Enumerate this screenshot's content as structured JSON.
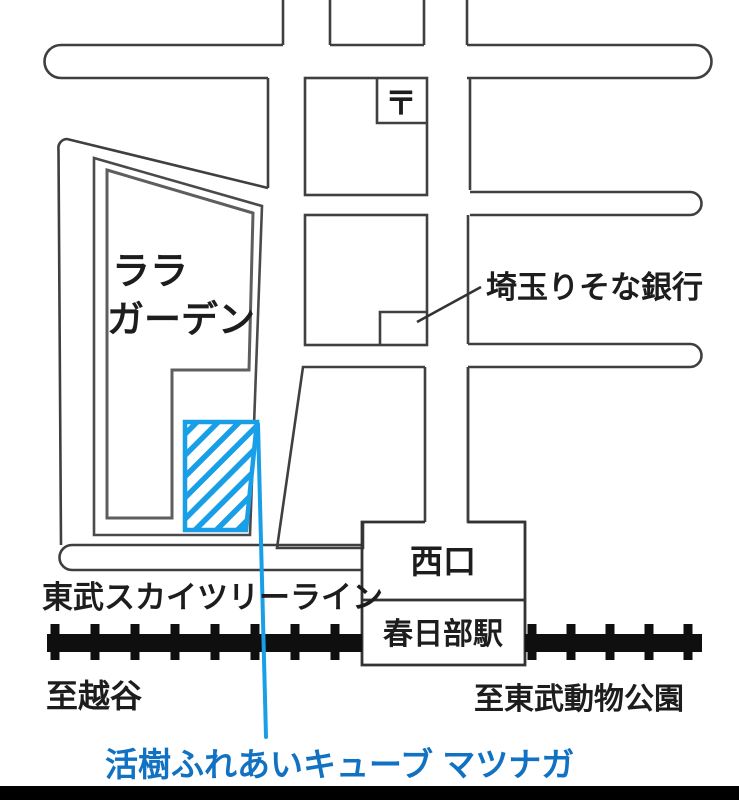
{
  "map": {
    "colors": {
      "street_line": "#3f3f3f",
      "block_outline": "#5e5e5e",
      "railway_black": "#0f0f0f",
      "highlight_blue": "#189fe8",
      "highlight_label_blue": "#1171c2"
    },
    "areas": {
      "lala_garden_line1": "ララ",
      "lala_garden_line2": "ガーデン",
      "post_office_mark": "〒",
      "bank_label": "埼玉りそな銀行",
      "west_exit": "西口",
      "station": "春日部駅"
    },
    "railway": {
      "line_name": "東武スカイツリーライン",
      "direction_left": "至越谷",
      "direction_right": "至東武動物公園"
    },
    "highlight": {
      "label": "活樹ふれあいキューブ マツナガ"
    }
  }
}
